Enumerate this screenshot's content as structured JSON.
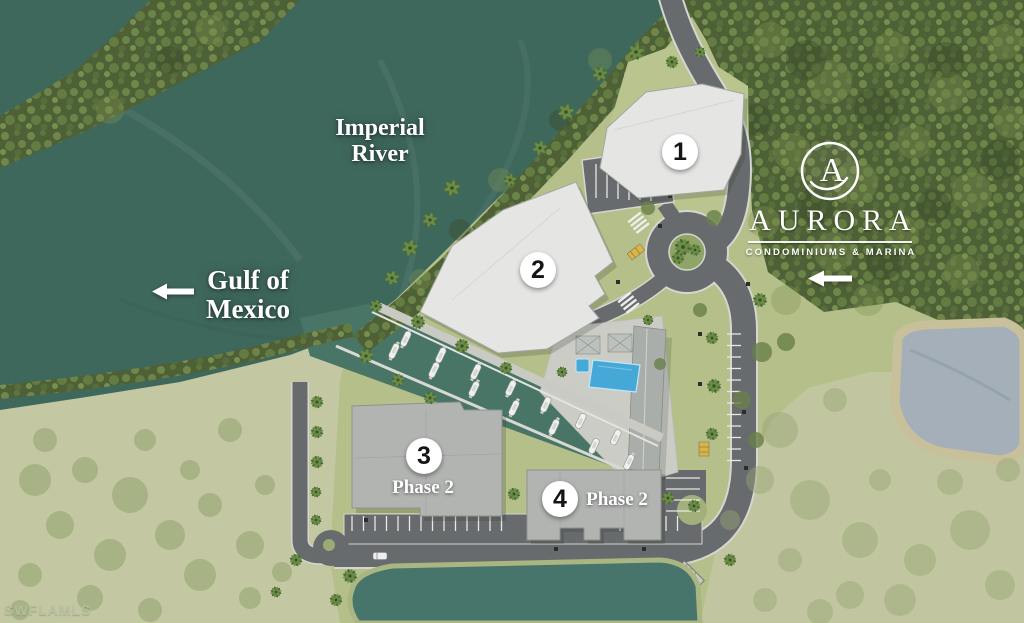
{
  "map_labels": {
    "river_line1": "Imperial",
    "river_line2": "River",
    "gulf_line1": "Gulf of",
    "gulf_line2": "Mexico"
  },
  "markers": {
    "b1": "1",
    "b2": "2",
    "b3": "3",
    "b4": "4",
    "phase3": "Phase 2",
    "phase4": "Phase 2"
  },
  "logo": {
    "monogram": "A",
    "brand": "AURORA",
    "tagline": "CONDOMINIUMS & MARINA"
  },
  "watermark": "SWFLAMLS",
  "colors": {
    "river_water": "#3f685d",
    "marina_water": "#497567",
    "mangrove_green": "#4e6036",
    "lawn_green": "#b4bf8a",
    "scrub_green": "#c3c7a2",
    "road_gray": "#686b6d",
    "building_light": "#e5e5e3",
    "building_gray": "#b2b4b2",
    "pool_blue": "#45a8d6",
    "pond_gray_blue": "#a4afba",
    "pond_teal": "#47746b"
  }
}
